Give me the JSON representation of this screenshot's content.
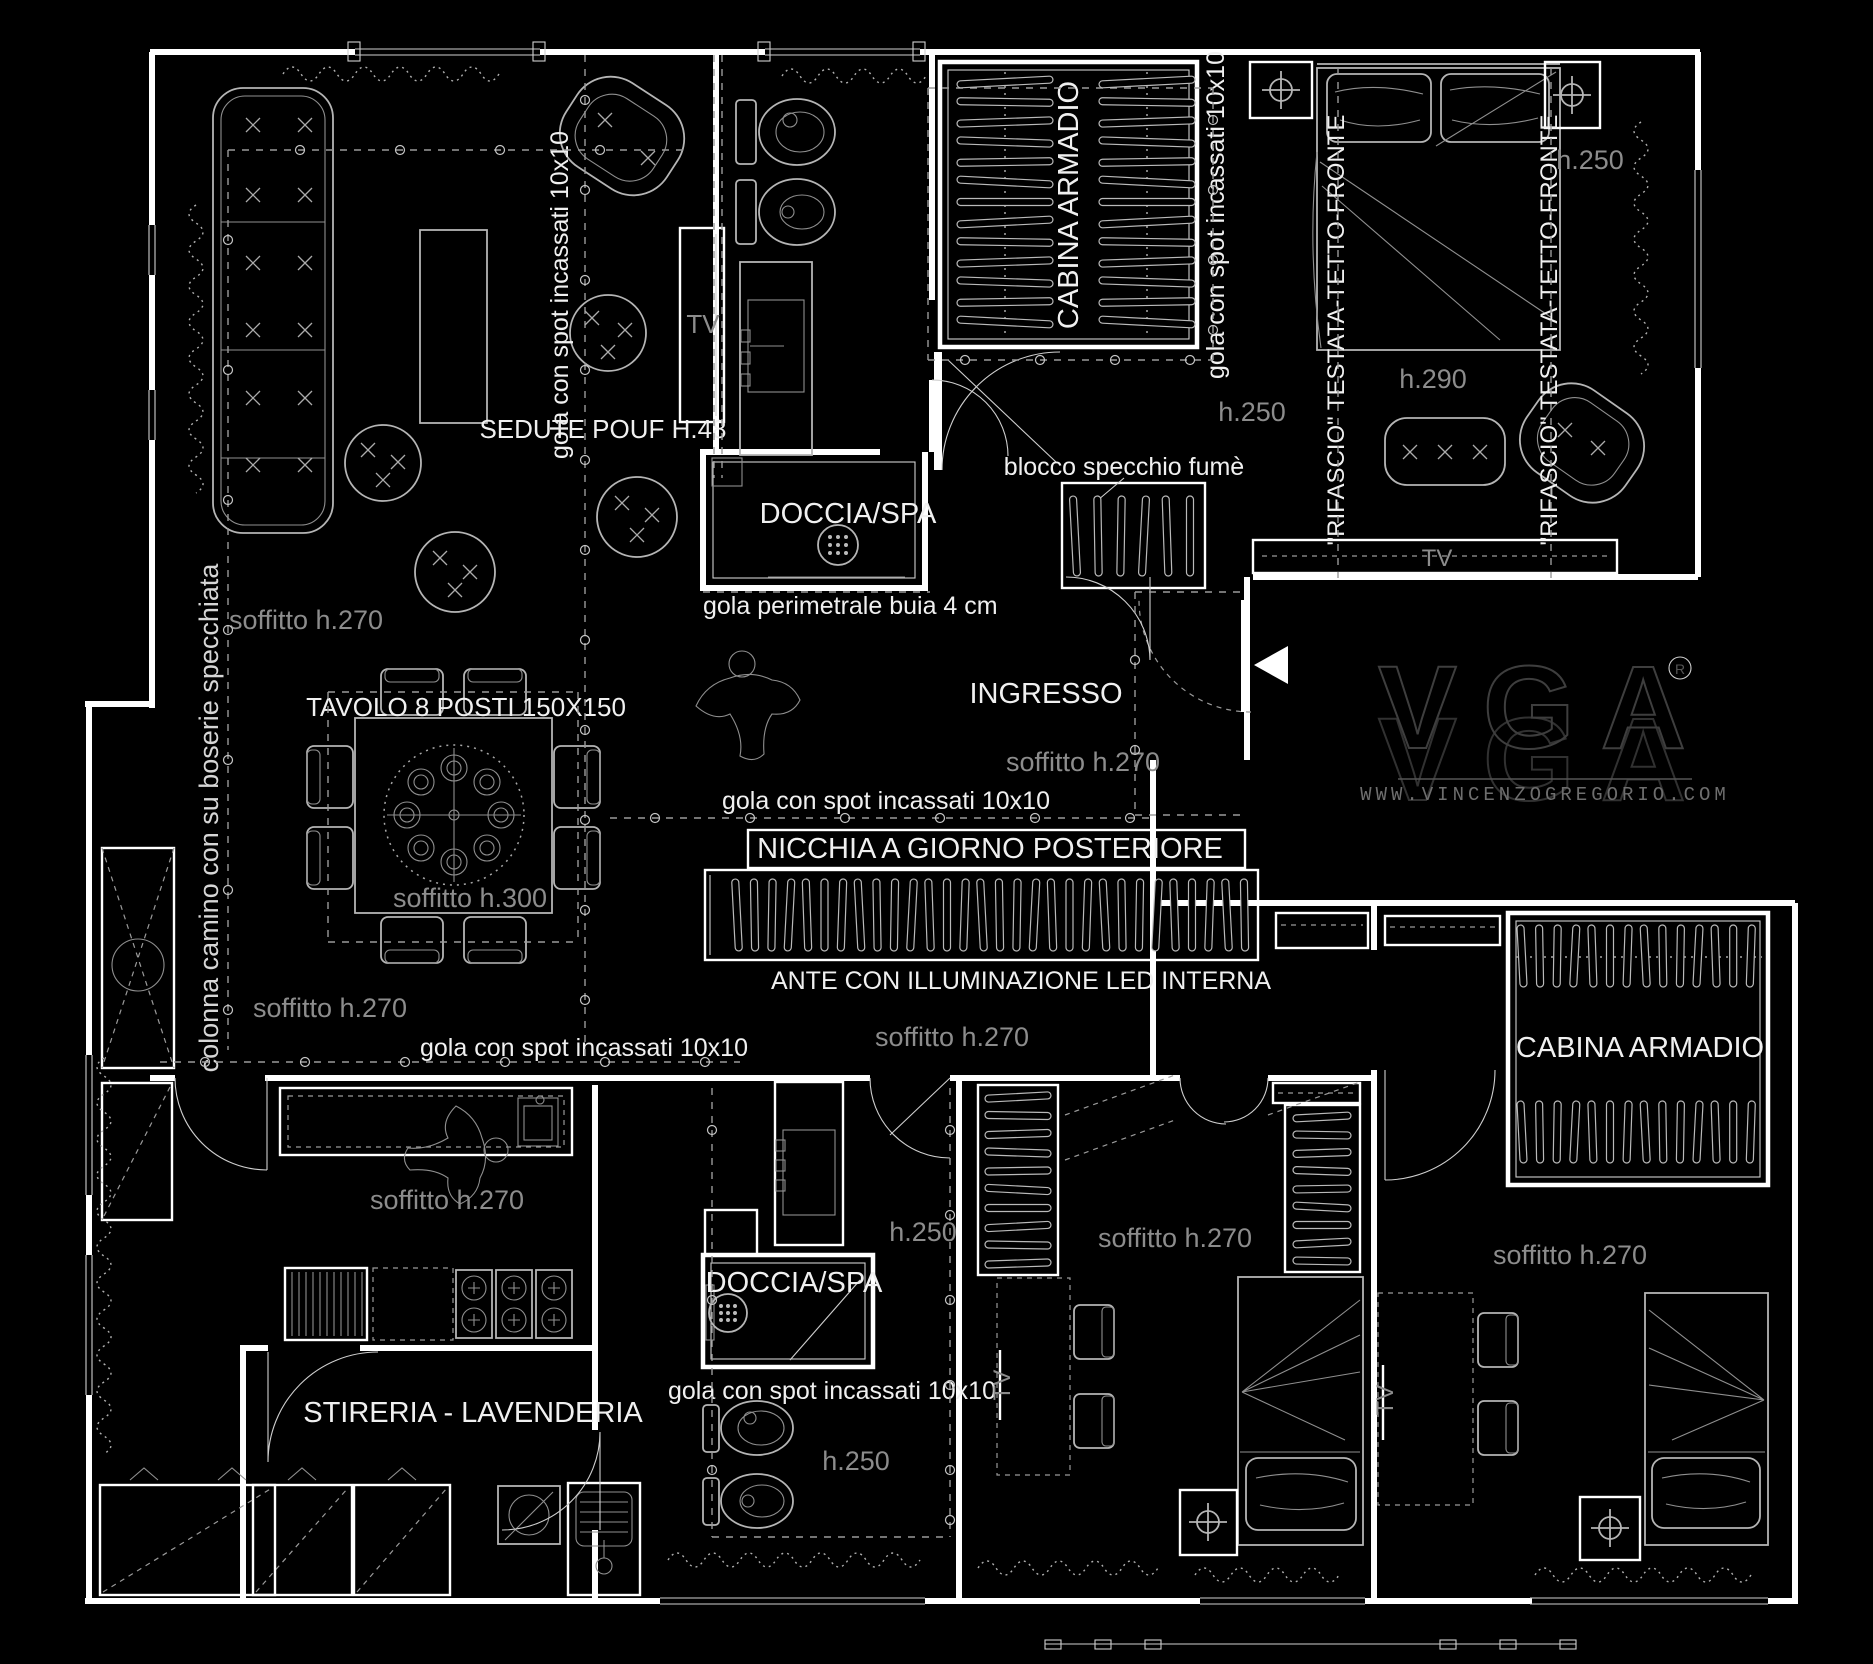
{
  "colors": {
    "background": "#000000",
    "walls": "#ffffff",
    "furniture_lines": "#b5b5b5",
    "label_white": "#f0f0f0",
    "label_gray": "#8c8c8c",
    "logo_outline": "#3e3e3e"
  },
  "labels": {
    "seating": "SEDUTE POUF H.48",
    "gola_spot_living": "gola con spot incassati 10x10",
    "tv_living": "TV",
    "ceiling_living": "soffitto h.270",
    "shower_top": "DOCCIA/SPA",
    "gola_perimeter": "gola perimetrale buia 4 cm",
    "closet_top": "CABINA ARMADIO",
    "gola_spot_closet": "gola con spot incassati 10x10",
    "h250_closet": "h.250",
    "mirror_block": "blocco specchio fumè",
    "rifascio_left": "\"RIFASCIO\" TESTATA-TETTO-FRONTE",
    "rifascio_right": "\"RIFASCIO\" TESTATA-TETTO-FRONTE",
    "h290_bed": "h.290",
    "h250_master": "h.250",
    "tv_master": "TV",
    "entry": "INGRESSO",
    "ceiling_entry": "soffitto h.270",
    "gola_spot_entry": "gola con spot incassati 10x10",
    "niche": "NICCHIA A GIORNO POSTERIORE",
    "doors_led": "ANTE  CON ILLUMINAZIONE LED INTERNA",
    "ceiling_niche": "soffitto h.270",
    "table": "TAVOLO 8 POSTI 150X150",
    "ceiling_table": "soffitto h.300",
    "ceiling_dining": "soffitto h.270",
    "column_note": "colonna camino con su boserie specchiata",
    "gola_spot_dining": "gola con spot incassati 10x10",
    "ceiling_kitchen": "soffitto h.270",
    "laundry": "STIRERIA - LAVENDERIA",
    "h250_bath2_top": "h.250",
    "shower_bottom": "DOCCIA/SPA",
    "gola_spot_bath2": "gola con spot incassati 10x10",
    "h250_bath2_bottom": "h.250",
    "ceiling_bed2": "soffitto h.270",
    "tv_bed2": "TV",
    "closet_bottom": "CABINA ARMADIO",
    "ceiling_bed3": "soffitto h.270",
    "tv_bed3": "TV"
  },
  "brand": {
    "logo": "VGA",
    "registered": "®",
    "website": "WWW.VINCENZOGREGORIO.COM"
  }
}
